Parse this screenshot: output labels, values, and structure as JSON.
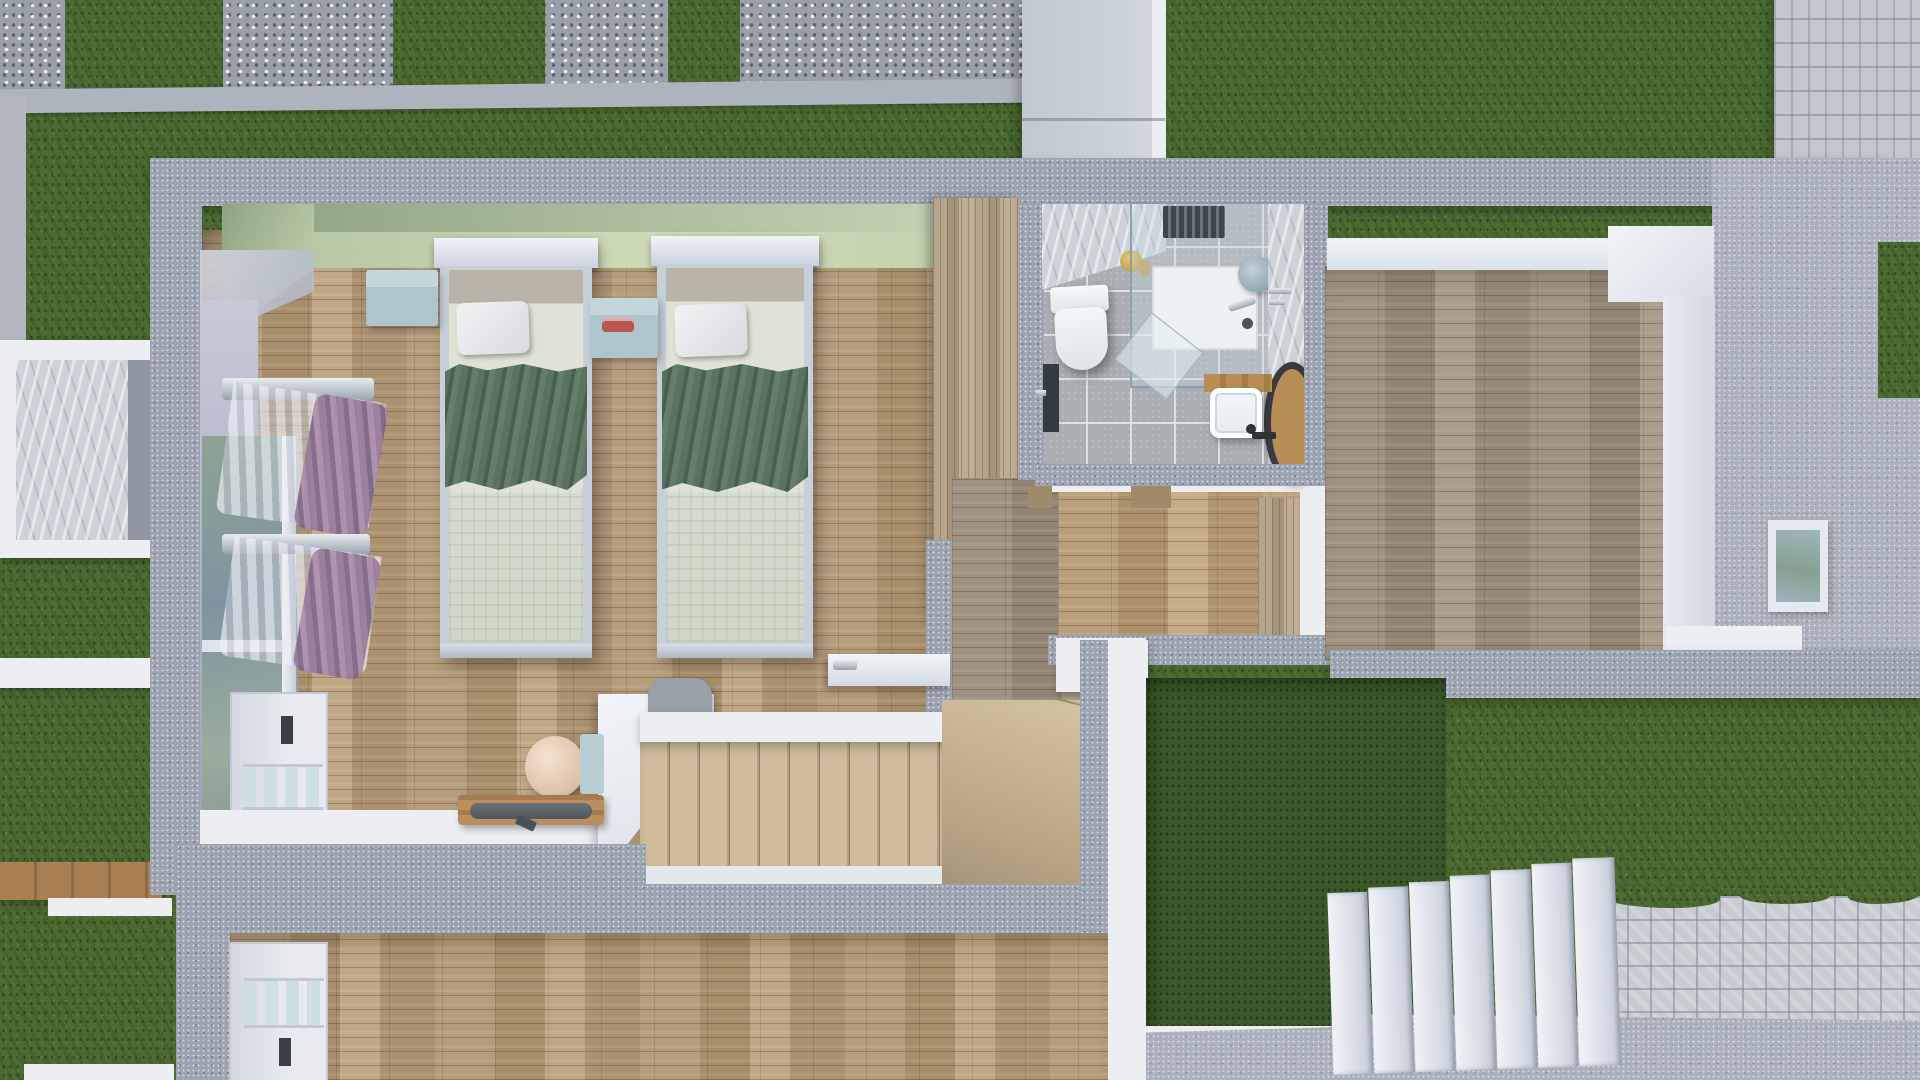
{
  "scene": {
    "title": "Top-down 3D render of an upper-floor house cutaway with garden",
    "view": "orthographic top-down cutaway",
    "rooms": [
      {
        "name": "kids-bedroom",
        "floor": "light oak parquet",
        "wall_accent": "sage green"
      },
      {
        "name": "bathroom",
        "floor": "grey stone tile",
        "wall_accent": "white marble"
      },
      {
        "name": "hallway-landing",
        "floor": "oak parquet"
      },
      {
        "name": "second-bedroom",
        "floor": "grey-washed oak parquet"
      },
      {
        "name": "stairwell",
        "treads": 14,
        "shape": "L-shaped with winders"
      },
      {
        "name": "lower-room",
        "floor": "oak parquet"
      },
      {
        "name": "inner-courtyard",
        "ground": "dark lawn"
      }
    ],
    "furniture": [
      "twin-bed-left",
      "twin-bed-right",
      "white-pillows",
      "green-blankets",
      "nightstand-left",
      "nightstand-between-beds",
      "red-alarm-clock",
      "sheer-curtains-with-purple-drapes",
      "built-in-wardrobe-wood",
      "white-closet-upper",
      "white-closet-lower",
      "desk-with-origami-wood-panels",
      "sphere-table-lamp",
      "wooden-tray-with-dark-plate",
      "grey-desk-chair"
    ],
    "fixtures": [
      "wall-hung-toilet",
      "walk-in-shower-glass",
      "round-rain-shower-head",
      "white-basin-on-wood-shelf",
      "round-wood-side-stool",
      "brass-soap-set",
      "chrome-towel-bar",
      "dark-interior-door"
    ],
    "exterior": [
      "gravel-slab-path-top",
      "lawn",
      "concrete-walkway-slab",
      "h-pattern-pavers-top-right",
      "left-lightwell-planter",
      "wooden-boardwalk-left",
      "white-marble-garden-steps",
      "basketweave-paver-path",
      "concrete-retaining-platform",
      "right-terrace-window"
    ],
    "palette": {
      "lawn": "#4c6a32",
      "courtyard_lawn": "#3b5829",
      "concrete_wall": "#9ca3b1",
      "gravel": "#99a0a9",
      "white_trim": "#eceef2",
      "parquet": "#b39a79",
      "grey_parquet": "#a59a85",
      "sage_wall": "#aebfa0",
      "lavender_wall": "#b2b6c7",
      "blanket_green": "#587161",
      "nightstand_blue": "#aec5cd",
      "clock_red": "#b9574e",
      "drape_purple": "#96799b",
      "marble": "#cdd2d9",
      "stair_wood": "#c7b494",
      "stool_wood": "#b98e54",
      "brass": "#c2a050"
    }
  }
}
